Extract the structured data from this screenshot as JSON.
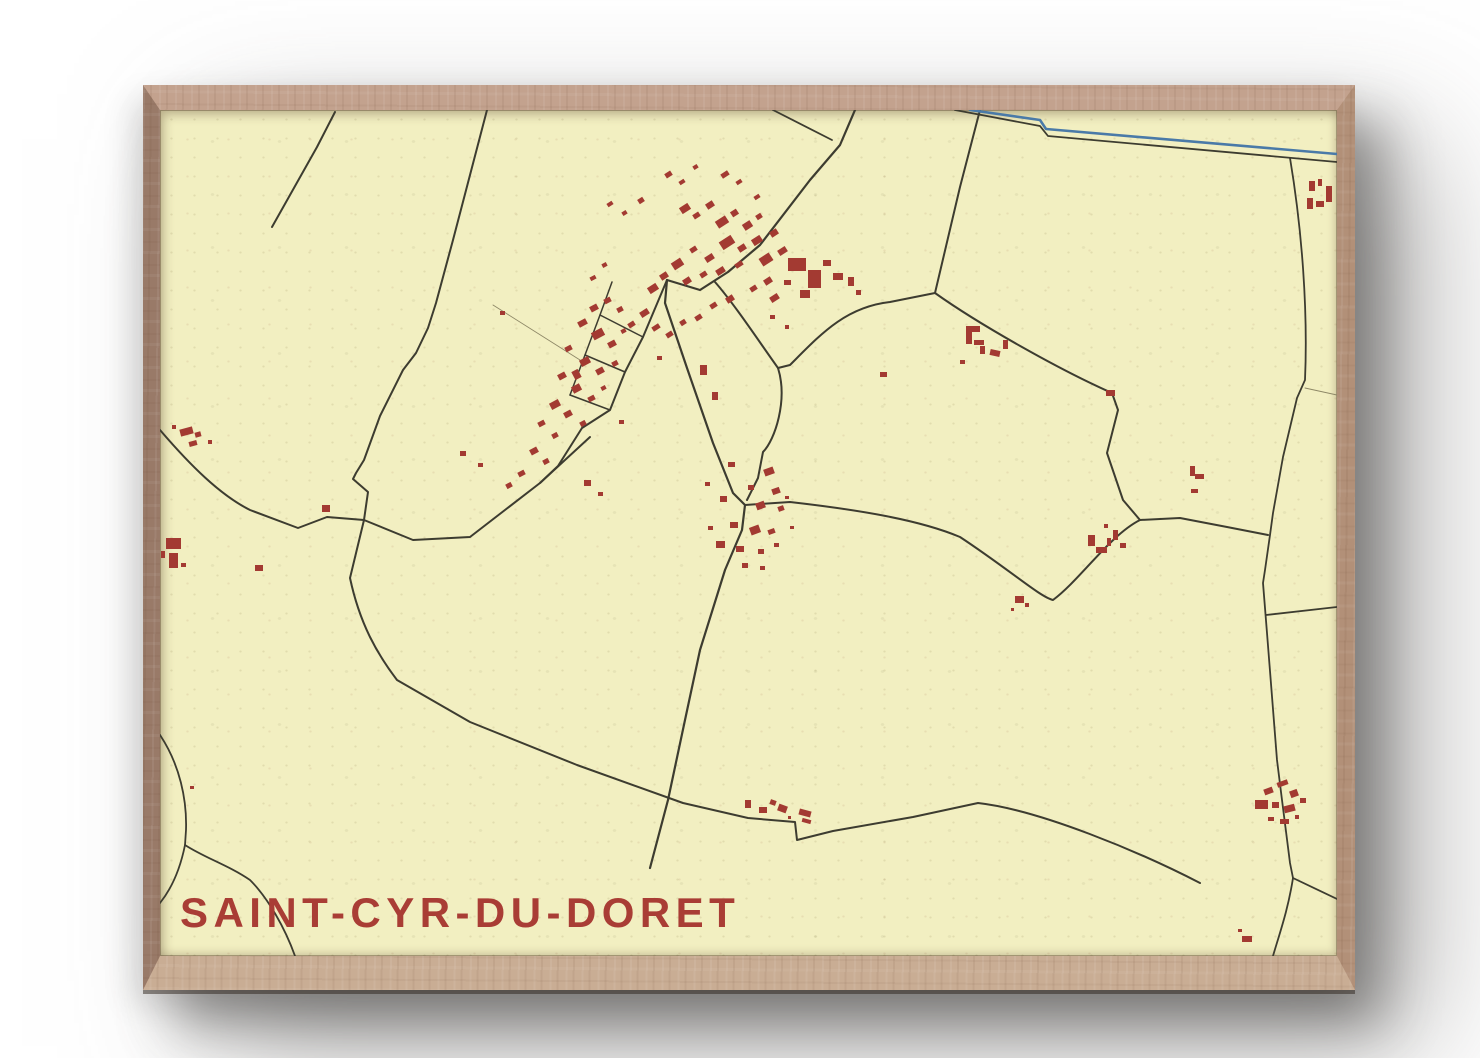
{
  "poster": {
    "title": "SAINT-CYR-DU-DORET"
  },
  "colors": {
    "page_bg": "#ffffff",
    "paper": "#f2efc1",
    "road": "#3d3c30",
    "path": "#8d8766",
    "building": "#a33a32",
    "river": "#4a7aa8",
    "title": "#a93d35",
    "frame_top": "#c3a28e",
    "frame_left": "#997a68",
    "frame_right": "#b29078",
    "frame_bottom": "#c9ad94"
  },
  "map": {
    "width": 1177,
    "height": 846,
    "roads": [
      {
        "n": "road-nw-deadend",
        "d": "M175,2 L157,37 112,117",
        "w": 2
      },
      {
        "n": "road-west-long",
        "d": "M327,0 L293,130 276,193 268,218 256,243 243,260 220,306 204,350 196,363 193,369 208,382 204,410",
        "w": 2
      },
      {
        "n": "road-bottom-diagonal",
        "d": "M204,410 L190,468 C200,515 218,545 237,570 L310,612 417,655 523,693 588,708 635,712 637,730 673,721 753,707 818,693 C880,700 980,742 1040,773",
        "w": 2
      },
      {
        "n": "road-west-horizontal",
        "d": "M0,320 C30,355 60,385 90,400 L138,418 167,407 204,410 253,430 310,427 380,373 430,327",
        "w": 2
      },
      {
        "n": "street-hamlet-main",
        "d": "M507,170 L483,227 465,262 450,300 422,318 398,356 380,373",
        "w": 2
      },
      {
        "n": "street-grid-rail",
        "d": "M452,172 L440,205 425,245 410,285",
        "w": 1.5
      },
      {
        "n": "street-grid-rung-1",
        "d": "M440,205 L483,227",
        "w": 1.5
      },
      {
        "n": "street-grid-rung-2",
        "d": "M425,245 L465,262",
        "w": 1.5
      },
      {
        "n": "street-grid-rung-3",
        "d": "M410,285 L450,300",
        "w": 1.5
      },
      {
        "n": "path-field",
        "d": "M333,195 L420,250",
        "w": 0.9,
        "t": "path"
      },
      {
        "n": "street-village-main",
        "d": "M695,0 L680,35 650,70 600,135 568,162 540,180 507,170",
        "w": 2.2
      },
      {
        "n": "road-village-branch-nw",
        "d": "M613,0 L672,30",
        "w": 1.8
      },
      {
        "n": "road-south",
        "d": "M507,170 L505,193 527,258 553,333 573,383 585,395 582,420 565,460 540,540 525,610 508,690 490,758",
        "w": 2.2
      },
      {
        "n": "road-loop-west",
        "d": "M555,172 C575,195 598,230 618,258 C628,290 615,330 603,342 L598,368 587,390",
        "w": 2
      },
      {
        "n": "road-loop-arc",
        "d": "M618,258 L630,255 C660,225 685,197 730,192 L775,183 C820,215 900,260 952,283 L958,300 947,343 963,390 980,410",
        "w": 2
      },
      {
        "n": "road-north-exit",
        "d": "M820,0 L800,77 775,183",
        "w": 2
      },
      {
        "n": "road-east-west-mid",
        "d": "M585,395 L630,392 C700,400 760,410 800,427 C850,460 880,487 893,490 C920,470 950,425 980,410 L1020,408 1067,417 1108,425",
        "w": 2
      },
      {
        "n": "road-right-vertical",
        "d": "M1130,48 C1142,120 1148,200 1145,270 L1137,288 1123,347 1113,403 1110,425 1105,460 1103,473 1107,523 1117,650 1122,690 1130,753 1133,768 C1128,800 1120,822 1113,846",
        "w": 1.8
      },
      {
        "n": "road-se-exit",
        "d": "M1106,505 L1177,497",
        "w": 1.8
      },
      {
        "n": "road-br-east",
        "d": "M1133,768 L1177,789",
        "w": 1.8
      },
      {
        "n": "road-canalside",
        "d": "M795,0 L880,16 888,26 1177,52",
        "w": 1.8
      },
      {
        "n": "river-canal",
        "d": "M810,0 L880,10 886,19 1177,44",
        "w": 2.6,
        "t": "river"
      },
      {
        "n": "road-left-edge",
        "d": "M0,625 C20,655 27,690 26,720 L25,735 C20,760 12,778 0,793",
        "w": 1.8
      },
      {
        "n": "road-left-branch",
        "d": "M25,735 C45,748 68,755 90,770 C108,788 125,818 135,846",
        "w": 1.8
      },
      {
        "n": "path-ne-spur",
        "d": "M1145,278 L1177,285",
        "w": 0.9,
        "t": "path"
      }
    ],
    "buildings": [
      [
        520,
        95,
        10,
        7,
        -33
      ],
      [
        533,
        103,
        7,
        5,
        -33
      ],
      [
        546,
        92,
        8,
        6,
        -33
      ],
      [
        556,
        108,
        12,
        8,
        -33
      ],
      [
        571,
        100,
        7,
        6,
        -33
      ],
      [
        583,
        112,
        9,
        7,
        -33
      ],
      [
        596,
        104,
        6,
        5,
        -33
      ],
      [
        560,
        128,
        14,
        9,
        -33
      ],
      [
        578,
        135,
        8,
        6,
        -33
      ],
      [
        592,
        127,
        10,
        7,
        -33
      ],
      [
        610,
        120,
        8,
        6,
        -33
      ],
      [
        545,
        145,
        9,
        6,
        -33
      ],
      [
        530,
        137,
        7,
        5,
        -33
      ],
      [
        512,
        150,
        11,
        8,
        -33
      ],
      [
        500,
        163,
        8,
        6,
        -33
      ],
      [
        488,
        175,
        10,
        7,
        -33
      ],
      [
        523,
        168,
        8,
        6,
        -33
      ],
      [
        540,
        162,
        7,
        5,
        -33
      ],
      [
        556,
        158,
        9,
        6,
        -33
      ],
      [
        575,
        152,
        8,
        5,
        -33
      ],
      [
        600,
        145,
        12,
        9,
        -33
      ],
      [
        618,
        138,
        9,
        6,
        -33
      ],
      [
        604,
        168,
        8,
        6,
        -33
      ],
      [
        590,
        176,
        7,
        5,
        -33
      ],
      [
        610,
        185,
        9,
        6,
        -33
      ],
      [
        566,
        186,
        8,
        6,
        -33
      ],
      [
        550,
        193,
        7,
        5,
        -33
      ],
      [
        480,
        200,
        9,
        6,
        -33
      ],
      [
        468,
        212,
        7,
        5,
        -33
      ],
      [
        492,
        215,
        8,
        5,
        -33
      ],
      [
        506,
        222,
        7,
        5,
        -33
      ],
      [
        520,
        210,
        6,
        5,
        -33
      ],
      [
        535,
        205,
        7,
        5,
        -33
      ],
      [
        628,
        148,
        18,
        13,
        0
      ],
      [
        648,
        160,
        13,
        18,
        0
      ],
      [
        640,
        180,
        10,
        8,
        0
      ],
      [
        663,
        150,
        8,
        6,
        0
      ],
      [
        673,
        163,
        10,
        7,
        0
      ],
      [
        624,
        170,
        7,
        5,
        0
      ],
      [
        688,
        167,
        6,
        9,
        0
      ],
      [
        696,
        180,
        5,
        5,
        0
      ],
      [
        505,
        62,
        7,
        5,
        -33
      ],
      [
        519,
        70,
        6,
        4,
        -33
      ],
      [
        478,
        88,
        6,
        5,
        -33
      ],
      [
        462,
        101,
        5,
        4,
        -33
      ],
      [
        447,
        92,
        6,
        4,
        -33
      ],
      [
        533,
        55,
        5,
        4,
        -33
      ],
      [
        561,
        62,
        8,
        5,
        -33
      ],
      [
        576,
        70,
        6,
        4,
        -33
      ],
      [
        594,
        85,
        6,
        4,
        -33
      ],
      [
        540,
        255,
        7,
        10,
        0
      ],
      [
        552,
        282,
        6,
        8,
        0
      ],
      [
        497,
        246,
        5,
        4,
        0
      ],
      [
        459,
        310,
        5,
        4,
        0
      ],
      [
        720,
        262,
        7,
        5,
        0
      ],
      [
        610,
        205,
        5,
        4,
        0
      ],
      [
        625,
        215,
        4,
        4,
        0
      ],
      [
        430,
        195,
        8,
        6,
        -28
      ],
      [
        444,
        188,
        7,
        5,
        -28
      ],
      [
        457,
        197,
        6,
        5,
        -28
      ],
      [
        418,
        210,
        9,
        6,
        -28
      ],
      [
        432,
        220,
        12,
        8,
        -28
      ],
      [
        448,
        231,
        8,
        6,
        -28
      ],
      [
        405,
        236,
        7,
        5,
        -28
      ],
      [
        420,
        248,
        10,
        7,
        -28
      ],
      [
        436,
        258,
        8,
        6,
        -28
      ],
      [
        452,
        251,
        6,
        5,
        -28
      ],
      [
        398,
        263,
        8,
        6,
        -28
      ],
      [
        412,
        275,
        9,
        7,
        -28
      ],
      [
        428,
        286,
        7,
        5,
        -28
      ],
      [
        390,
        291,
        10,
        7,
        -28
      ],
      [
        404,
        301,
        8,
        6,
        -28
      ],
      [
        378,
        311,
        7,
        5,
        -28
      ],
      [
        392,
        323,
        6,
        5,
        -28
      ],
      [
        370,
        338,
        8,
        6,
        -28
      ],
      [
        383,
        349,
        6,
        5,
        -28
      ],
      [
        420,
        311,
        6,
        5,
        -28
      ],
      [
        441,
        276,
        5,
        4,
        -28
      ],
      [
        461,
        219,
        5,
        4,
        -28
      ],
      [
        358,
        361,
        7,
        5,
        -28
      ],
      [
        346,
        373,
        6,
        5,
        -28
      ],
      [
        442,
        153,
        5,
        4,
        -28
      ],
      [
        430,
        166,
        6,
        4,
        -28
      ],
      [
        300,
        341,
        6,
        5,
        0
      ],
      [
        318,
        353,
        5,
        4,
        0
      ],
      [
        340,
        201,
        5,
        4,
        0
      ],
      [
        413,
        260,
        7,
        9,
        -28
      ],
      [
        424,
        370,
        7,
        6,
        0
      ],
      [
        438,
        382,
        5,
        4,
        0
      ],
      [
        568,
        352,
        7,
        5,
        0
      ],
      [
        604,
        358,
        10,
        7,
        -20
      ],
      [
        588,
        375,
        6,
        5,
        0
      ],
      [
        612,
        378,
        8,
        6,
        -20
      ],
      [
        560,
        386,
        7,
        6,
        0
      ],
      [
        596,
        392,
        9,
        7,
        -20
      ],
      [
        618,
        396,
        6,
        5,
        -20
      ],
      [
        570,
        412,
        8,
        6,
        0
      ],
      [
        590,
        416,
        10,
        8,
        -20
      ],
      [
        608,
        419,
        7,
        5,
        -20
      ],
      [
        556,
        431,
        9,
        7,
        0
      ],
      [
        576,
        436,
        8,
        6,
        0
      ],
      [
        598,
        439,
        6,
        5,
        0
      ],
      [
        614,
        433,
        5,
        4,
        0
      ],
      [
        582,
        453,
        6,
        5,
        0
      ],
      [
        600,
        456,
        5,
        4,
        0
      ],
      [
        548,
        416,
        5,
        4,
        0
      ],
      [
        625,
        386,
        4,
        3,
        0
      ],
      [
        630,
        416,
        4,
        3,
        0
      ],
      [
        545,
        372,
        5,
        4,
        0
      ],
      [
        806,
        216,
        14,
        6,
        0
      ],
      [
        806,
        222,
        6,
        12,
        0
      ],
      [
        814,
        230,
        10,
        5,
        0
      ],
      [
        820,
        236,
        5,
        8,
        0
      ],
      [
        830,
        240,
        10,
        6,
        12
      ],
      [
        843,
        230,
        5,
        9,
        0
      ],
      [
        800,
        250,
        5,
        4,
        0
      ],
      [
        946,
        280,
        9,
        6,
        0
      ],
      [
        928,
        425,
        7,
        11,
        0
      ],
      [
        936,
        437,
        11,
        6,
        0
      ],
      [
        947,
        428,
        4,
        8,
        0
      ],
      [
        953,
        420,
        5,
        10,
        0
      ],
      [
        960,
        433,
        6,
        5,
        0
      ],
      [
        944,
        414,
        4,
        4,
        0
      ],
      [
        1030,
        356,
        5,
        10,
        0
      ],
      [
        1035,
        364,
        9,
        5,
        0
      ],
      [
        1031,
        379,
        7,
        4,
        0
      ],
      [
        855,
        486,
        9,
        7,
        0
      ],
      [
        865,
        493,
        4,
        4,
        0
      ],
      [
        851,
        498,
        3,
        3,
        0
      ],
      [
        20,
        318,
        13,
        7,
        -15
      ],
      [
        35,
        322,
        6,
        5,
        -15
      ],
      [
        29,
        331,
        8,
        5,
        -15
      ],
      [
        48,
        330,
        4,
        4,
        0
      ],
      [
        12,
        315,
        4,
        4,
        0
      ],
      [
        6,
        428,
        15,
        11,
        0
      ],
      [
        9,
        443,
        9,
        15,
        0
      ],
      [
        1,
        441,
        4,
        7,
        0
      ],
      [
        21,
        453,
        5,
        4,
        0
      ],
      [
        162,
        395,
        8,
        7,
        0
      ],
      [
        95,
        455,
        8,
        6,
        0
      ],
      [
        30,
        676,
        4,
        3,
        0
      ],
      [
        585,
        690,
        6,
        8,
        0
      ],
      [
        599,
        697,
        8,
        6,
        0
      ],
      [
        610,
        690,
        6,
        5,
        20
      ],
      [
        618,
        695,
        9,
        7,
        20
      ],
      [
        639,
        700,
        12,
        6,
        15
      ],
      [
        642,
        709,
        9,
        4,
        15
      ],
      [
        628,
        706,
        3,
        3,
        0
      ],
      [
        1104,
        678,
        9,
        6,
        -20
      ],
      [
        1117,
        671,
        11,
        5,
        -20
      ],
      [
        1130,
        680,
        8,
        7,
        -20
      ],
      [
        1095,
        690,
        13,
        9,
        0
      ],
      [
        1112,
        692,
        7,
        6,
        0
      ],
      [
        1124,
        695,
        11,
        7,
        -15
      ],
      [
        1140,
        688,
        6,
        5,
        0
      ],
      [
        1108,
        707,
        6,
        4,
        0
      ],
      [
        1120,
        709,
        9,
        5,
        0
      ],
      [
        1135,
        705,
        4,
        4,
        0
      ],
      [
        1082,
        826,
        10,
        6,
        0
      ],
      [
        1078,
        819,
        4,
        3,
        0
      ],
      [
        1149,
        71,
        6,
        10,
        0
      ],
      [
        1158,
        69,
        4,
        7,
        0
      ],
      [
        1147,
        88,
        6,
        11,
        0
      ],
      [
        1156,
        91,
        8,
        6,
        0
      ],
      [
        1166,
        76,
        6,
        16,
        0
      ]
    ]
  }
}
